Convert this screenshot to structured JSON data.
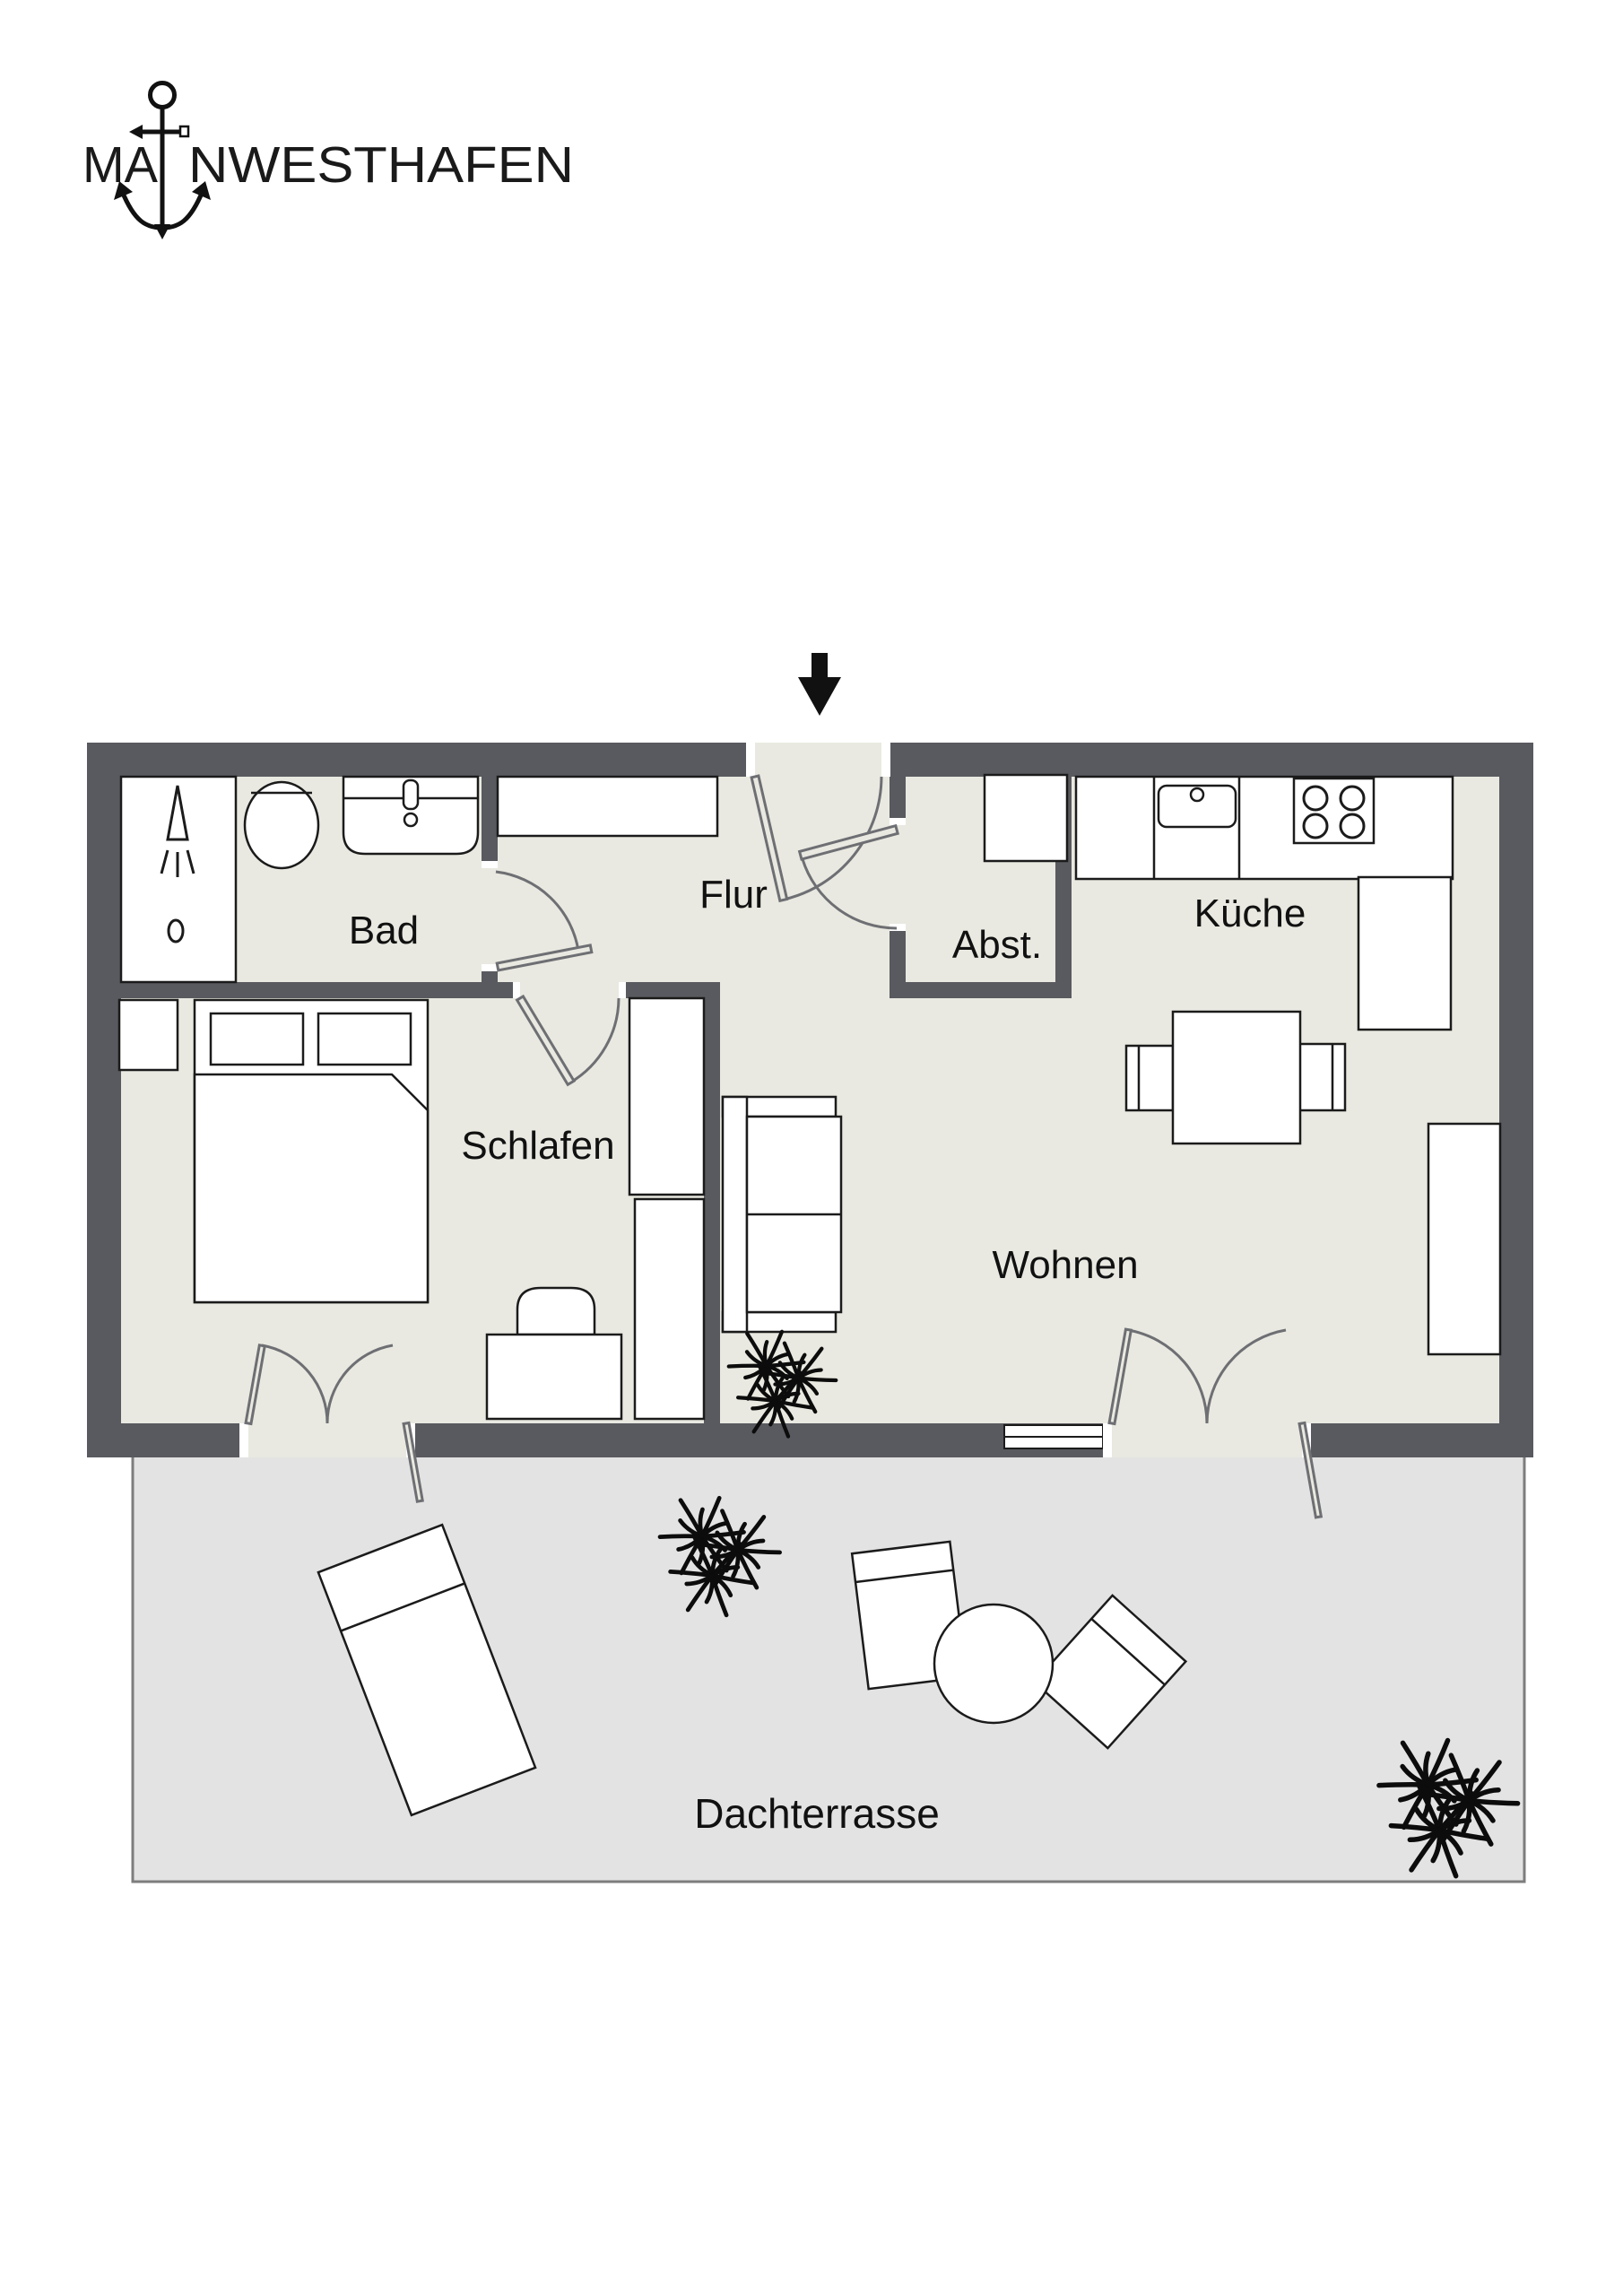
{
  "logo": {
    "word_start": "MA",
    "word_end": "NWESTHAFEN",
    "icon": "anchor-icon"
  },
  "entrance": {
    "icon": "entrance-arrow-down"
  },
  "rooms": {
    "bad": "Bad",
    "flur": "Flur",
    "abst": "Abst.",
    "kueche": "Küche",
    "schlafen": "Schlafen",
    "wohnen": "Wohnen",
    "terrasse": "Dachterrasse"
  },
  "fixtures": [
    "shower-icon",
    "toilet-icon",
    "washbasin-icon",
    "hall-cabinet",
    "storage-shelf",
    "kitchen-counter",
    "kitchen-sink-icon",
    "stove-icon",
    "tall-kitchen-unit",
    "dining-table",
    "dining-chair",
    "bed",
    "pillow",
    "nightstand",
    "wardrobe",
    "desk",
    "desk-chair",
    "sofa",
    "sideboard",
    "sun-lounger",
    "terrace-table",
    "terrace-chair",
    "plant-icon"
  ],
  "colors": {
    "wall": "#595a5f",
    "floor": "#e9e9e1",
    "terrace": "#e3e3e3",
    "terrace_border": "#7d7d7d",
    "door_swing": "#6e6f73",
    "label": "#111111",
    "logo_ink": "#1a1a1a",
    "background": "#ffffff"
  }
}
